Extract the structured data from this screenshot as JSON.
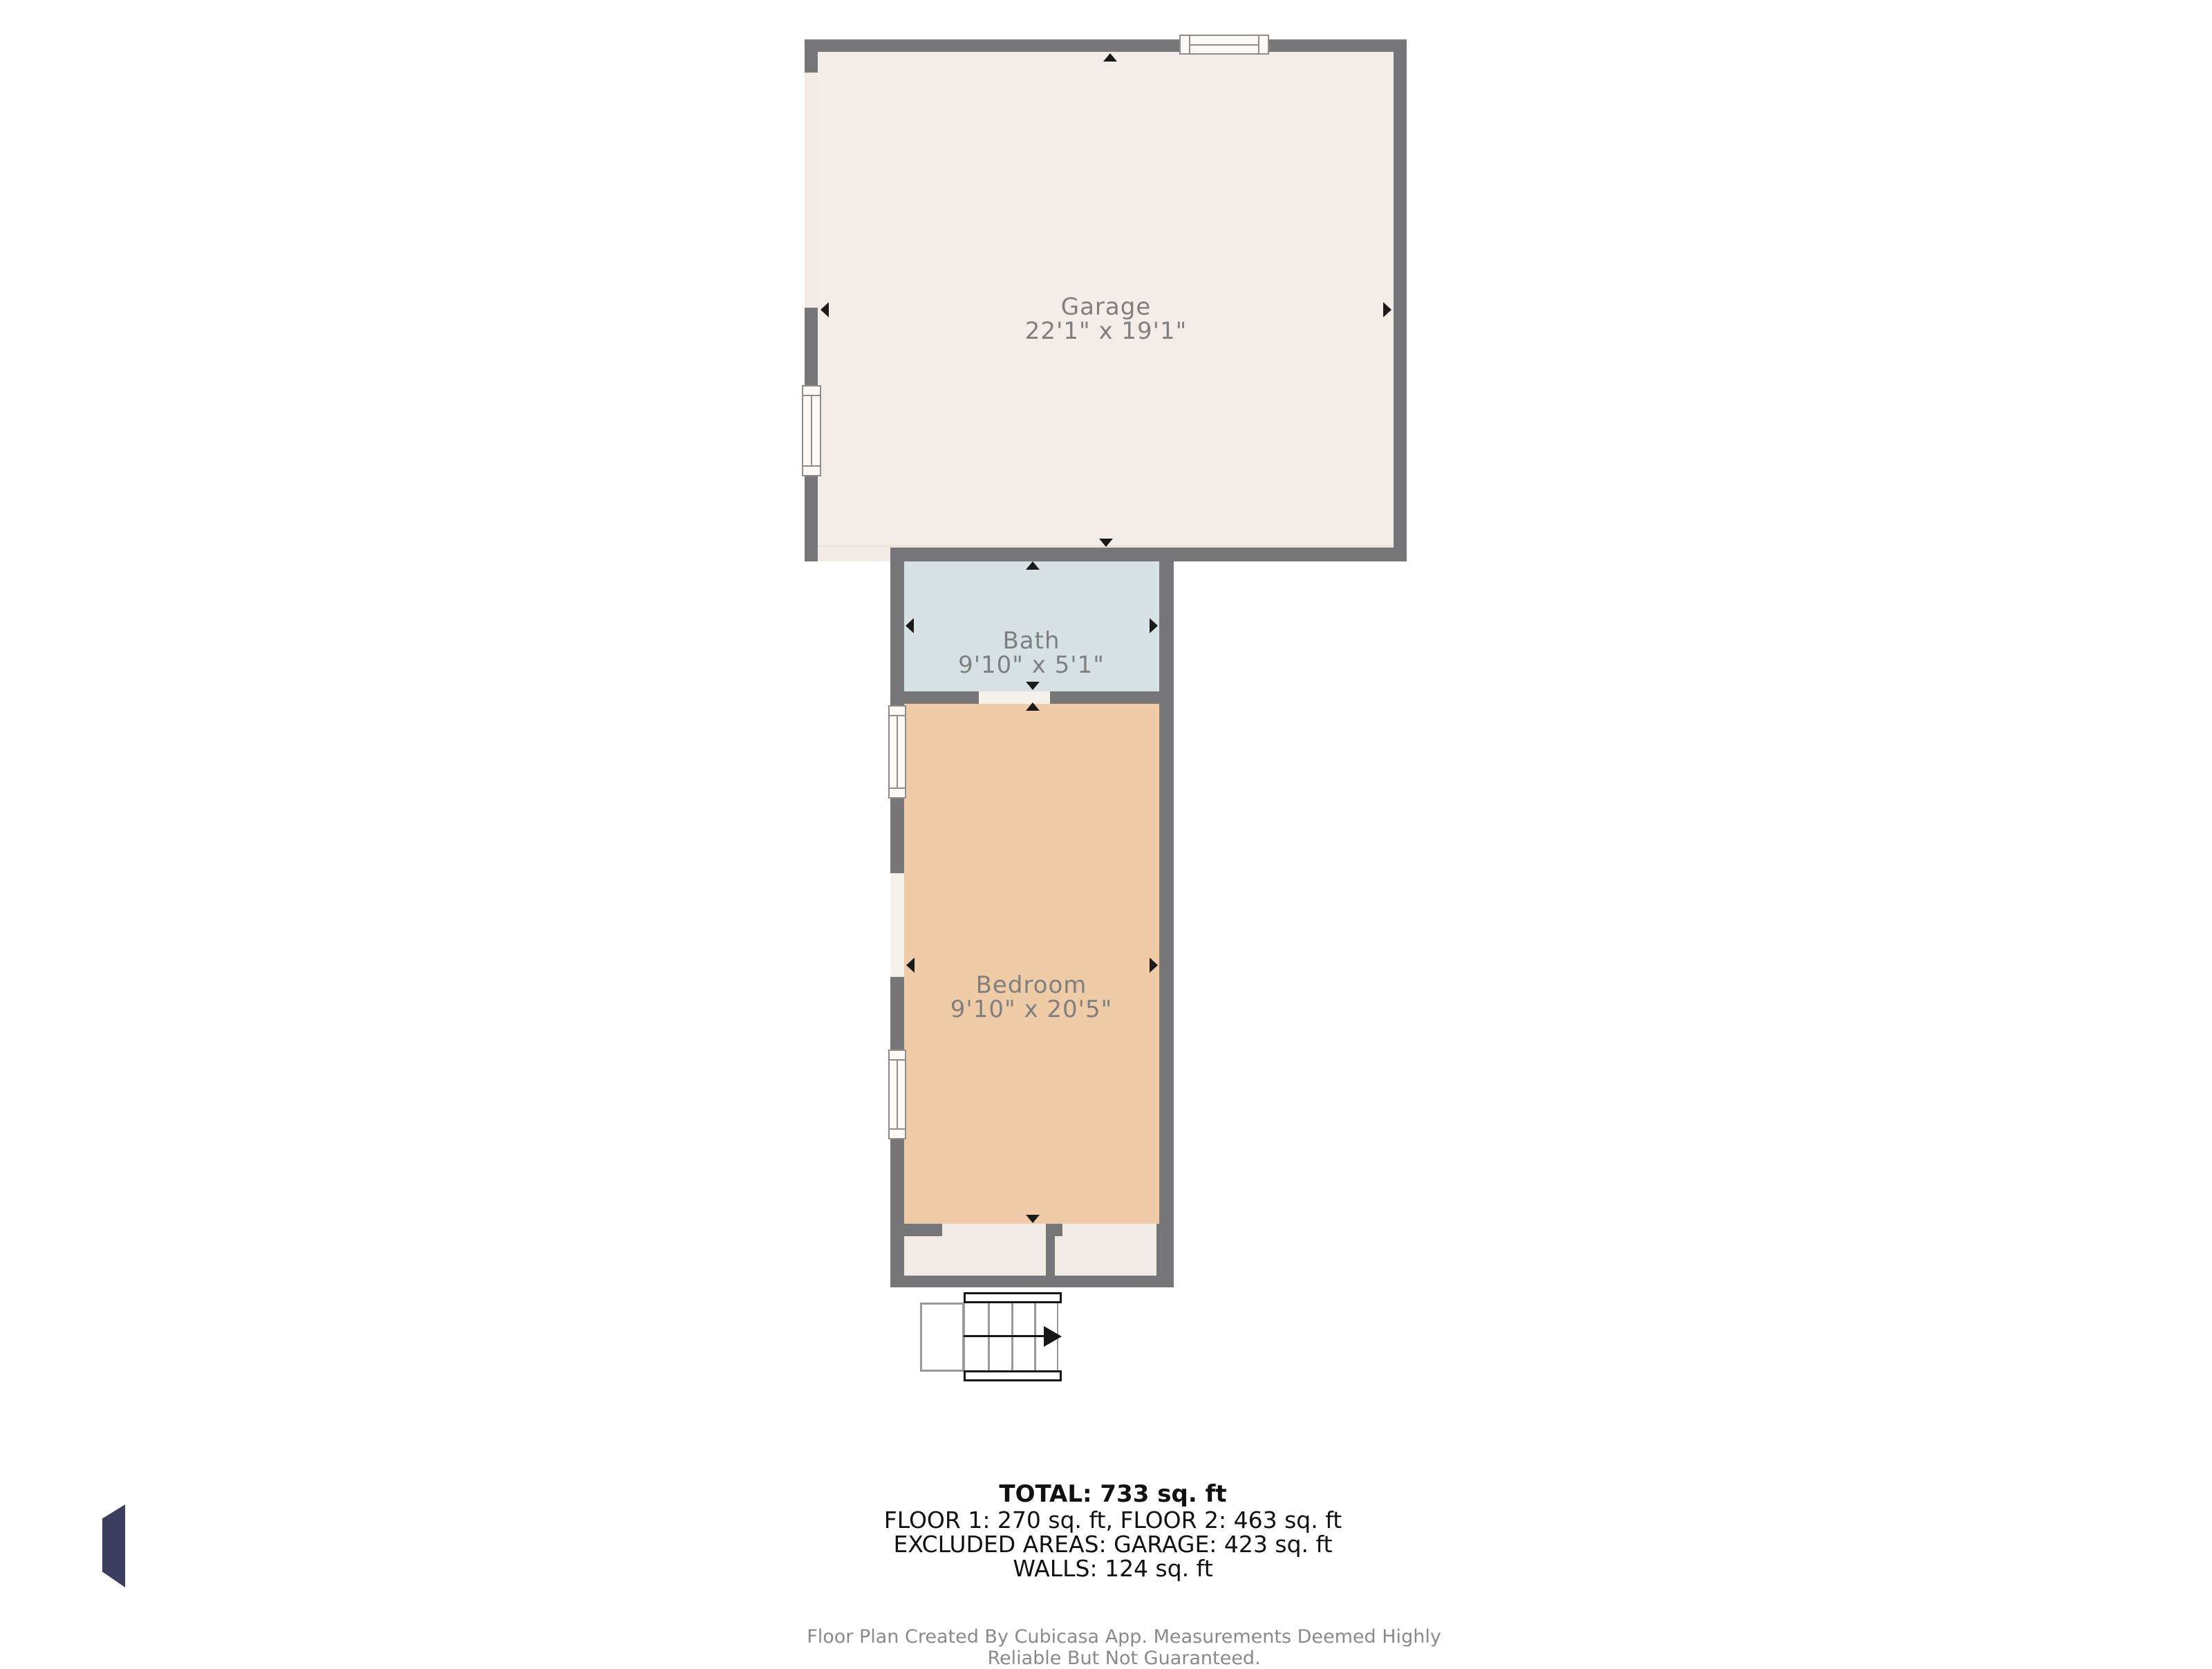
{
  "plan": {
    "rooms": [
      {
        "name": "Garage",
        "dims": "22'1\" x 19'1\""
      },
      {
        "name": "Bath",
        "dims": "9'10\" x 5'1\""
      },
      {
        "name": "Bedroom",
        "dims": "9'10\" x 20'5\""
      }
    ]
  },
  "summary": {
    "total": "TOTAL: 733 sq. ft",
    "floors": "FLOOR 1: 270 sq. ft, FLOOR 2: 463 sq. ft",
    "excluded": "EXCLUDED AREAS: GARAGE: 423 sq. ft",
    "walls": "WALLS: 124 sq. ft"
  },
  "footer": {
    "disclaimer": "Floor Plan Created By Cubicasa App. Measurements Deemed Highly Reliable But Not Guaranteed."
  },
  "colors": {
    "wall": "#777779",
    "garage_floor": "#f4ece6",
    "bath_floor": "#d6e2e3",
    "bedroom_floor": "#f0cba8",
    "closet_floor": "#f3ebe5",
    "logo": "#3b3e5e",
    "label_text": "#7f7f7f",
    "summary_text": "#111111",
    "disclaimer_text": "#8a8a8a"
  }
}
